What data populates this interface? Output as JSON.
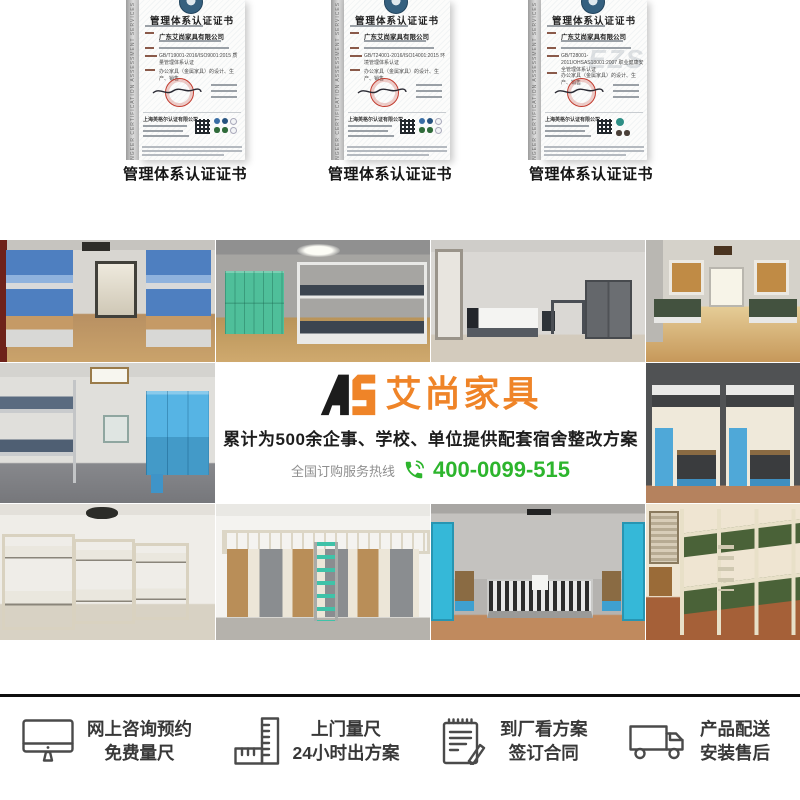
{
  "certificates": {
    "caption": "管理体系认证证书",
    "title": "管理体系认证证书",
    "side_text": "INGEER CERTIFICATION ASSESSMENT SERVICES",
    "company": "广东艾尚家具有限公司",
    "issuer": "上海英格尔认证有限公司",
    "scope": "办公家具（金属家具）的设计、生产、销售",
    "items": [
      {
        "standard": "GB/T19001-2016/ISO9001:2015 质量管理体系认证"
      },
      {
        "standard": "GB/T24001-2016/ISO14001:2015 环境管理体系认证"
      },
      {
        "standard": "GB/T28001-2011/OHSAS18001:2007 职业健康安全管理体系认证",
        "watermark": "EZS"
      }
    ]
  },
  "banner": {
    "logo_mark": "AS",
    "logo_text": "艾尚家具",
    "tagline": "累计为500余企事、学校、单位提供配套宿舍整改方案",
    "hotline_label": "全国订购服务热线",
    "hotline_number": "400-0099-515",
    "colors": {
      "orange": "#EF8428",
      "green": "#2DB52D",
      "black": "#1c1c1c"
    }
  },
  "services": {
    "items": [
      {
        "icon": "monitor-icon",
        "line1": "网上咨询预约",
        "line2": "免费量尺"
      },
      {
        "icon": "ruler-icon",
        "line1": "上门量尺",
        "line2": "24小时出方案"
      },
      {
        "icon": "contract-icon",
        "line1": "到厂看方案",
        "line2": "签订合同"
      },
      {
        "icon": "truck-icon",
        "line1": "产品配送",
        "line2": "安装售后"
      }
    ]
  },
  "photos": [
    {
      "name": "dorm-blue-bunks-desks"
    },
    {
      "name": "green-lockers-white-bunk"
    },
    {
      "name": "single-bed-desk-cabinet"
    },
    {
      "name": "wood-floor-dorm-beds"
    },
    {
      "name": "bunk-and-blue-wardrobe-room"
    },
    {
      "name": "dark-loft-units-blue-lockers"
    },
    {
      "name": "cream-bunk-bed-room"
    },
    {
      "name": "loft-wardrobe-desk-combo"
    },
    {
      "name": "blue-doors-single-beds"
    },
    {
      "name": "green-military-bunks"
    }
  ]
}
